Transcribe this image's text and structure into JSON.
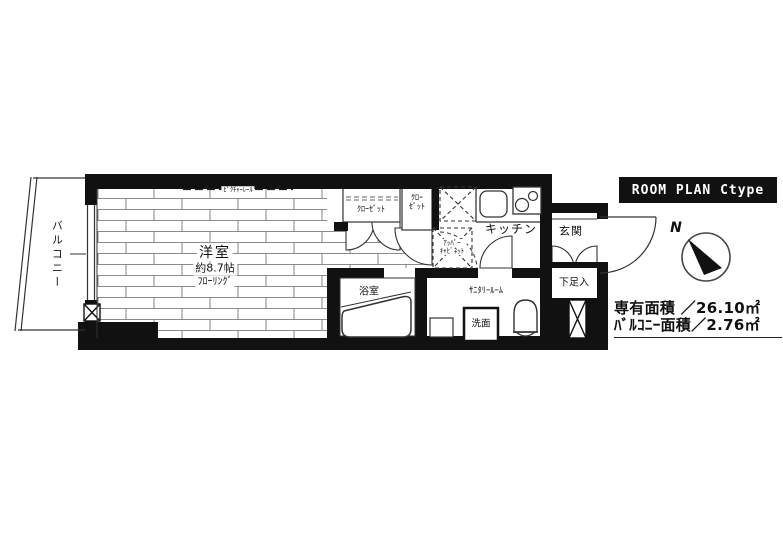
{
  "header": {
    "label": "ROOM PLAN  Ctype"
  },
  "compass": {
    "north": "N"
  },
  "rooms": {
    "balcony": {
      "label": "バルコニー"
    },
    "western_room": {
      "name": "洋室",
      "size": "約8.7帖",
      "flooring": "ﾌﾛｰﾘﾝｸﾞ",
      "picture_rail": "ﾋﾟｸﾁｬｰﾚｰﾙ"
    },
    "closet_1": {
      "label": "ｸﾛｰｾﾞｯﾄ"
    },
    "closet_2": {
      "line1": "ｸﾛｰ",
      "line2": "ｾﾞｯﾄ"
    },
    "upper_cabinet": {
      "line1": "ｱｯﾊﾟｰ",
      "line2": "ｷｬﾋﾞﾈｯﾄ"
    },
    "kitchen": {
      "label": "キッチン"
    },
    "entrance": {
      "label": "玄関"
    },
    "shoe_cabinet": {
      "label": "下足入"
    },
    "bathroom": {
      "label": "浴室"
    },
    "sanitary_room": {
      "label": "ｻﾆﾀﾘｰﾙｰﾑ"
    },
    "washbasin": {
      "label": "洗面"
    }
  },
  "area_summary": {
    "exclusive_area": "専有面積 ／26.10㎡",
    "balcony_area": "ﾊﾞﾙｺﾆｰ面積／2.76㎡"
  },
  "colors": {
    "wall": "#111111",
    "line": "#333333",
    "background": "#ffffff",
    "header_bg": "#111111",
    "header_text": "#ffffff"
  }
}
